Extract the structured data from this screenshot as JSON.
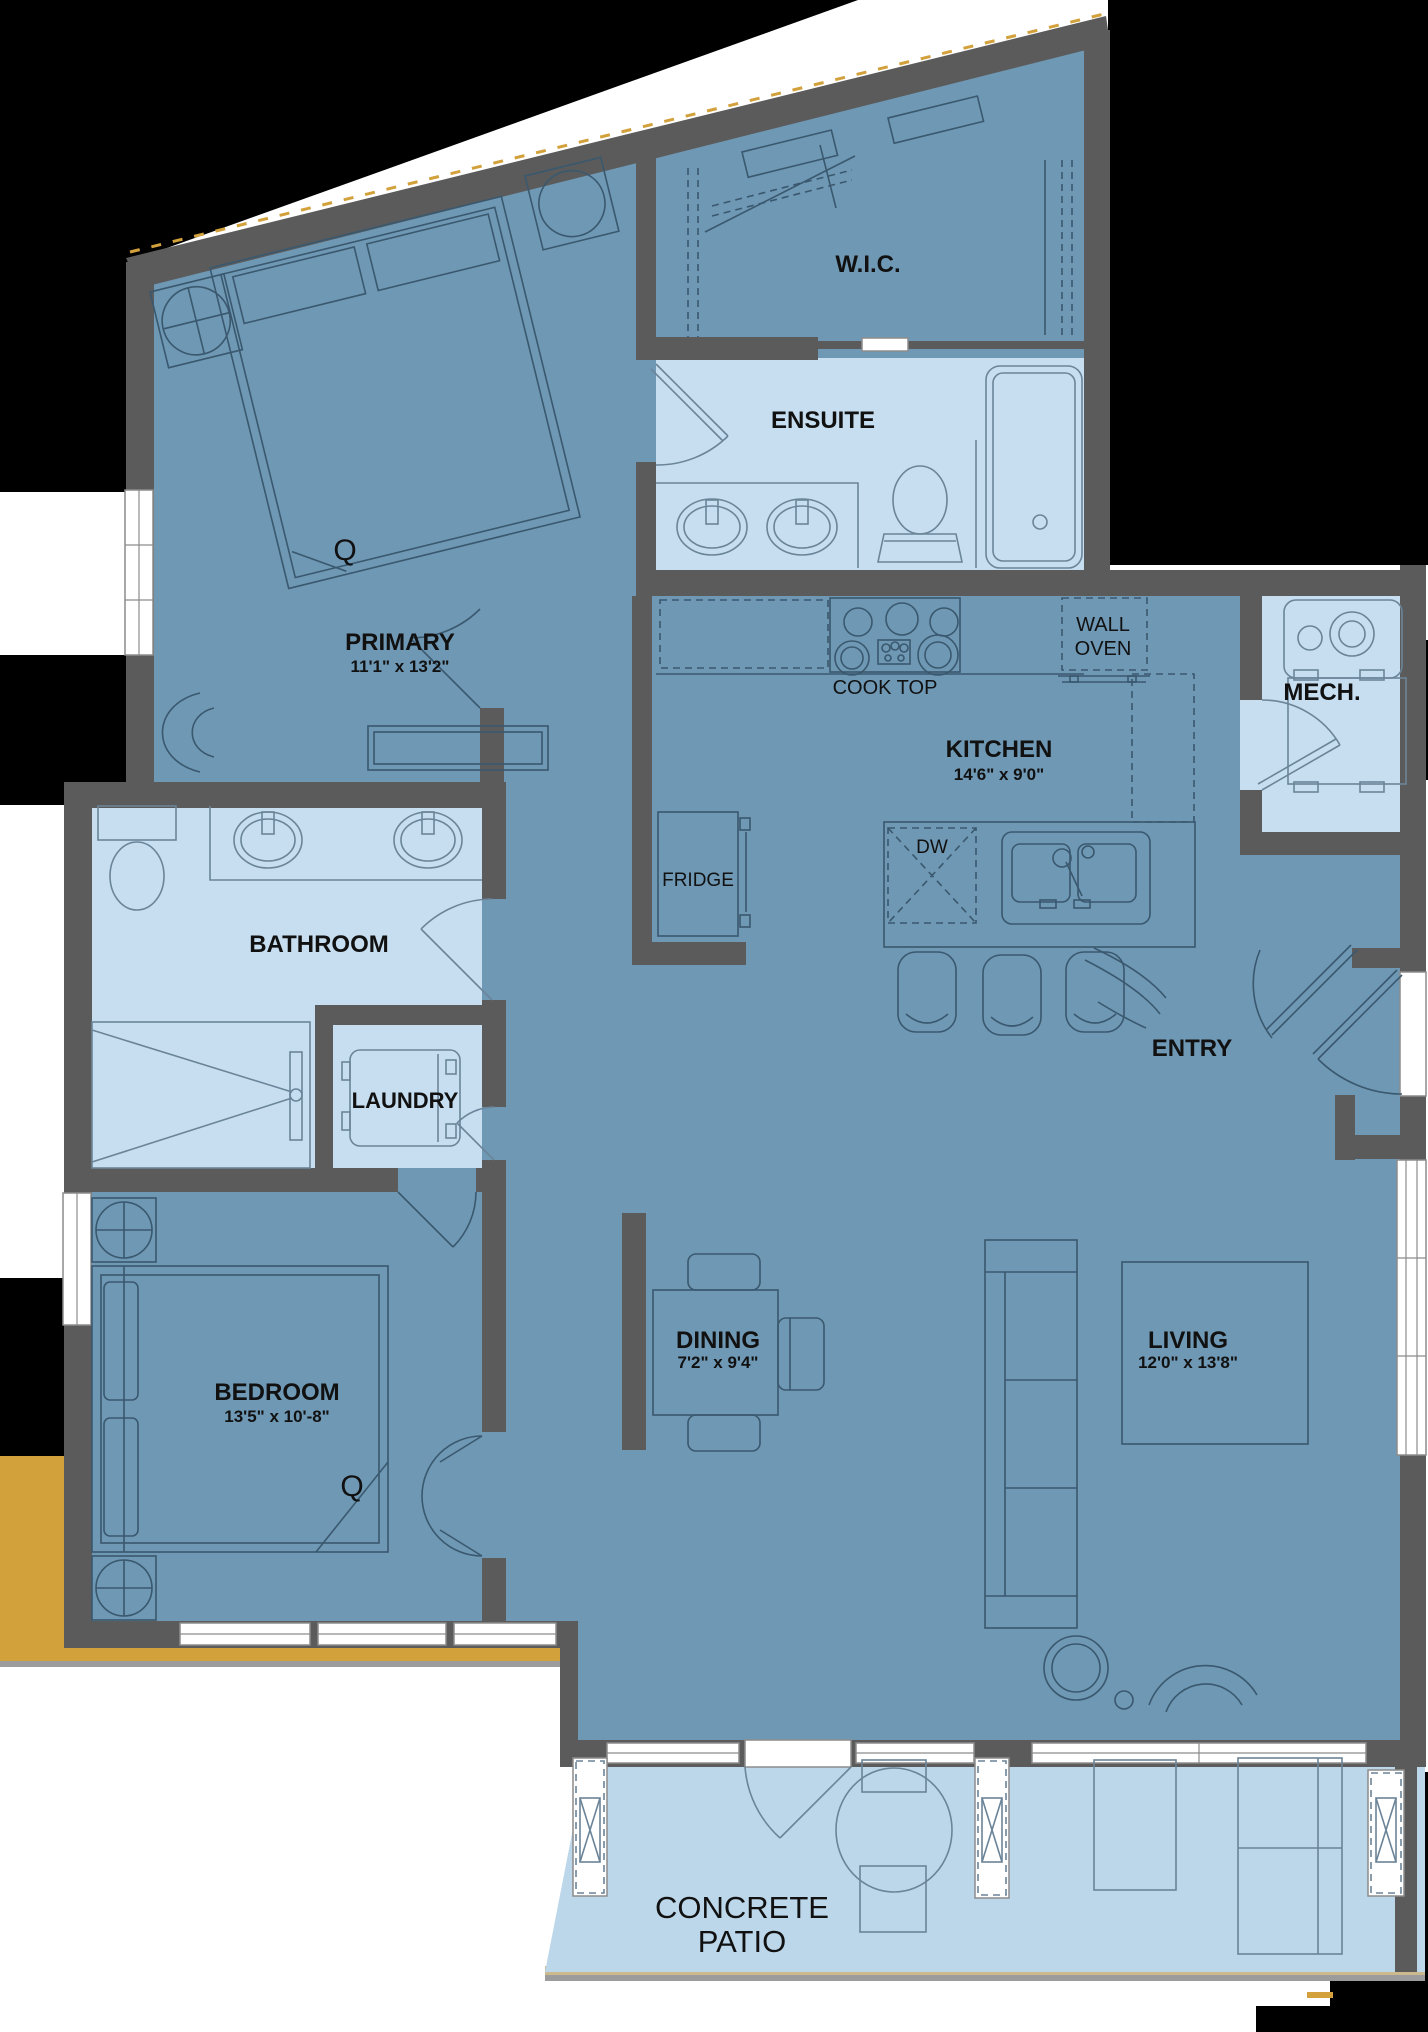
{
  "plan": {
    "rooms": {
      "wic": {
        "name": "W.I.C."
      },
      "ensuite": {
        "name": "ENSUITE"
      },
      "primary": {
        "name": "PRIMARY",
        "dims": "11'1\" x 13'2\"",
        "bed_size": "Q"
      },
      "kitchen": {
        "name": "KITCHEN",
        "dims": "14'6\" x 9'0\""
      },
      "mech": {
        "name": "MECH."
      },
      "bathroom": {
        "name": "BATHROOM"
      },
      "laundry": {
        "name": "LAUNDRY"
      },
      "entry": {
        "name": "ENTRY"
      },
      "bedroom": {
        "name": "BEDROOM",
        "dims": "13'5\" x 10'-8\"",
        "bed_size": "Q"
      },
      "dining": {
        "name": "DINING",
        "dims": "7'2\" x 9'4\""
      },
      "living": {
        "name": "LIVING",
        "dims": "12'0\" x 13'8\""
      },
      "patio": {
        "line1": "CONCRETE",
        "line2": "PATIO"
      }
    },
    "labels": {
      "wall_oven_line1": "WALL",
      "wall_oven_line2": "OVEN",
      "cook_top": "COOK TOP",
      "fridge": "FRIDGE",
      "dishwasher": "DW"
    },
    "colors": {
      "room_fill": "#6E98B4",
      "wet_room_fill": "#C6DEF0",
      "patio_fill": "#BCD7EA",
      "wall": "#5B5B5B",
      "exterior": "#000000",
      "site_gold": "#D2A13C",
      "line_dark": "#3A586E",
      "line_light": "#6B8498",
      "text": "#111111"
    }
  }
}
